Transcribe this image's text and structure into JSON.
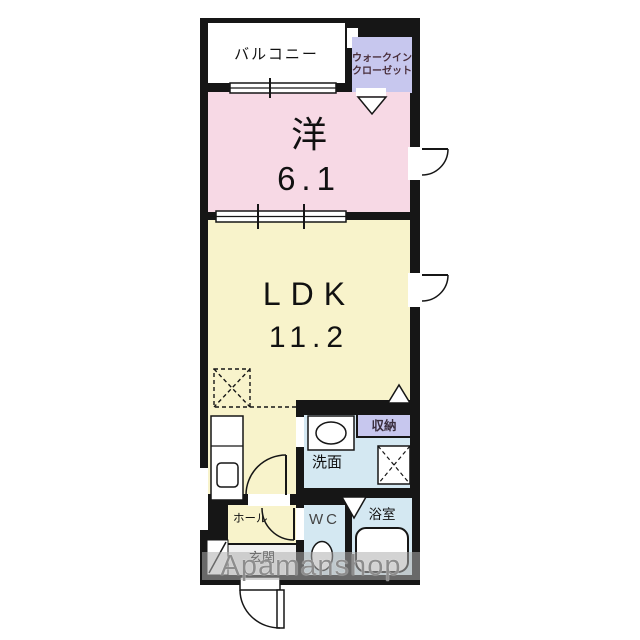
{
  "plan": {
    "rooms": {
      "balcony": {
        "label": "バルコニー"
      },
      "walk_in_closet": {
        "label_line1": "ウォークイン",
        "label_line2": "クローゼット"
      },
      "western_room": {
        "label": "洋",
        "size": "6.1"
      },
      "ldk": {
        "label": "LDK",
        "size": "11.2"
      },
      "storage": {
        "label": "収納"
      },
      "washroom": {
        "label": "洗面"
      },
      "wc": {
        "label": "WC"
      },
      "bathroom": {
        "label": "浴室"
      },
      "hall": {
        "label": "ホール"
      },
      "entrance": {
        "label": "玄関"
      }
    },
    "watermark": {
      "text": "Apamanshop"
    },
    "colors": {
      "wall": "#161616",
      "western_room_fill": "#f7d9e5",
      "ldk_fill": "#f8f3cb",
      "wet_area_fill": "#d4e8f2",
      "closet_fill": "#c7c7ee",
      "watermark_text": "#8d8d8d"
    }
  }
}
